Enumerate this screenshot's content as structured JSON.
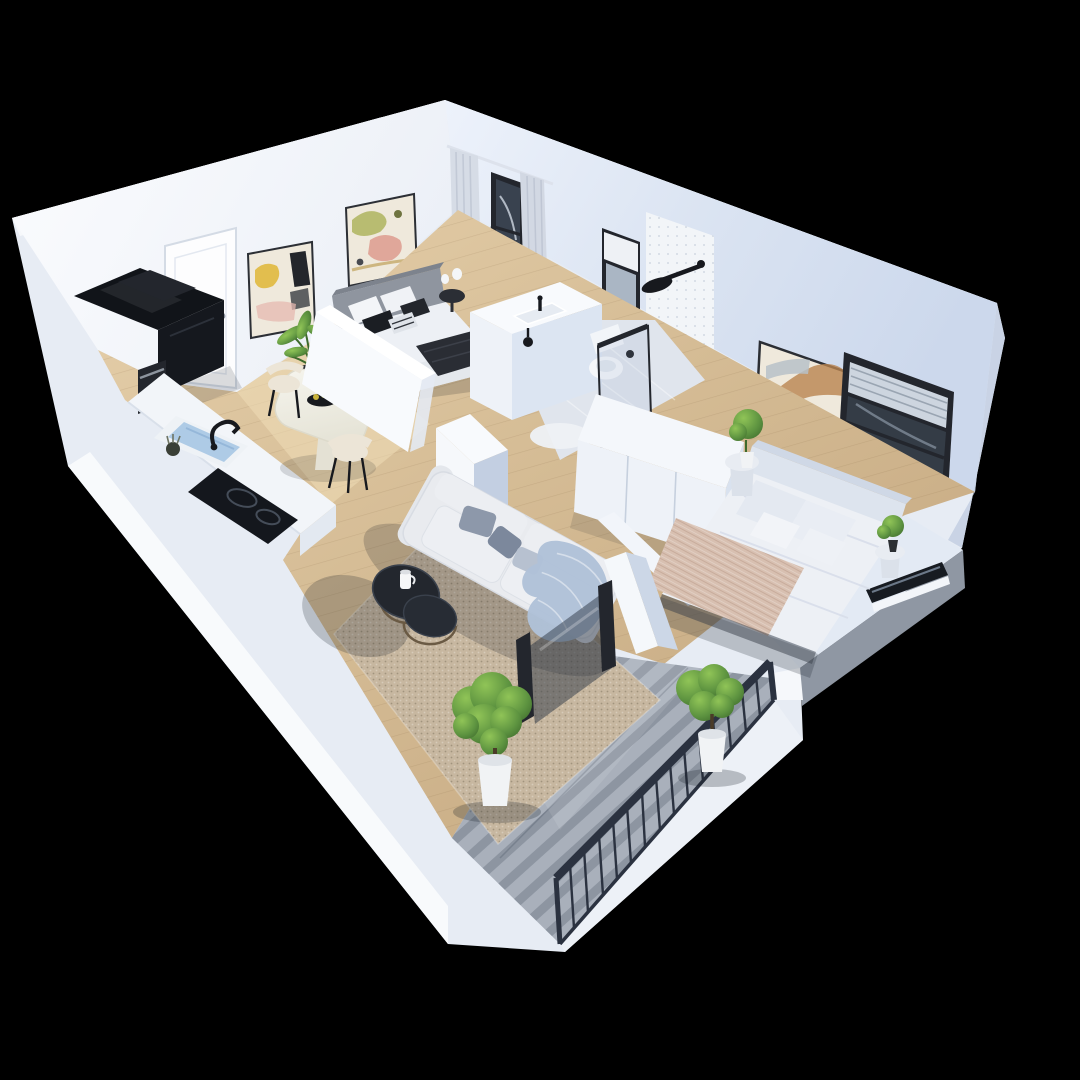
{
  "canvas": {
    "width": 1080,
    "height": 1080
  },
  "scene": {
    "type": "isometric-apartment-cutaway-render",
    "description": "3D cutaway floor plan of a one-bedroom-plus-studio apartment with balcony, viewed from above on a black background",
    "rooms": [
      {
        "name": "Entry Hall",
        "furniture": [
          "front-door",
          "abstract-wall-art",
          "abstract-wall-art-2"
        ]
      },
      {
        "name": "Kitchen",
        "furniture": [
          "black-refrigerator",
          "coffee-machine",
          "counter",
          "sink",
          "black-faucet",
          "induction-cooktop"
        ]
      },
      {
        "name": "Dining Area",
        "furniture": [
          "round-dining-table",
          "fruit-bowl",
          "cream-chair",
          "cream-chair",
          "potted-palm",
          "side-stool"
        ]
      },
      {
        "name": "Bedroom One",
        "furniture": [
          "gray-upholstered-bed",
          "black-pillows",
          "dark-throw",
          "round-nightstand",
          "vases",
          "tall-window",
          "curtains"
        ]
      },
      {
        "name": "Bathroom",
        "furniture": [
          "vanity-basin",
          "black-tap",
          "wall-lamp",
          "toilet",
          "rain-shower",
          "glass-screen",
          "tiled-wall",
          "shaded-window",
          "round-mat"
        ]
      },
      {
        "name": "Bedroom Two",
        "furniture": [
          "white-double-bed",
          "knit-throw",
          "wardrobe",
          "pedestal-side-table",
          "pedestal-side-table",
          "potted-tree",
          "potted-bush",
          "large-wall-art",
          "roman-shade-window",
          "low-window"
        ]
      },
      {
        "name": "Living Room",
        "furniture": [
          "cream-sofa",
          "gray-cushions",
          "blue-throw-blanket",
          "nesting-coffee-tables",
          "candle-jug",
          "area-rug",
          "sliding-glass-door"
        ]
      },
      {
        "name": "Balcony",
        "furniture": [
          "metal-railing",
          "tile-floor",
          "potted-plant",
          "potted-plant"
        ]
      }
    ]
  },
  "palette": {
    "background": "#000000",
    "wall_top": "#e7ecf4",
    "wall_light": "#f8fafd",
    "wall_blue": "#dce5f2",
    "wall_shade": "#c3cfe2",
    "wall_deep": "#aebdd4",
    "floor_wood": "#d7bf9c",
    "floor_hall": "#e8d2a9",
    "tile_bath": "#e0e5ed",
    "tile_balcony": "#a9b0bb",
    "rug": "#c7b7a0",
    "railing": "#2b3240",
    "frame_dark": "#23262d",
    "glass_dark": "#39434f",
    "glass_pane": "#9db0c2",
    "appliance_black": "#111419",
    "counter_white": "#f2f5f9",
    "sink_water": "#aecbe6",
    "sofa": "#e9ebef",
    "cushion_gray": "#8d98aa",
    "throw_blue": "#b0c1d8",
    "bed1_headboard": "#8f959f",
    "bed_white": "#edf0f5",
    "throw_dark": "#2a2d34",
    "throw_pink": "#d8c0b1",
    "wardrobe": "#eef2f8",
    "plant_green": "#5d9340",
    "plant_deep": "#3e6a2c",
    "pot_white": "#f1f3f5",
    "art_cream": "#efe9dc",
    "art_yellow": "#e0b93e",
    "art_pink": "#e5b8b0",
    "art_brown": "#b9834f",
    "chair_cream": "#ece5d7",
    "table_white": "#f0efe8",
    "shadow": "#141a24"
  }
}
